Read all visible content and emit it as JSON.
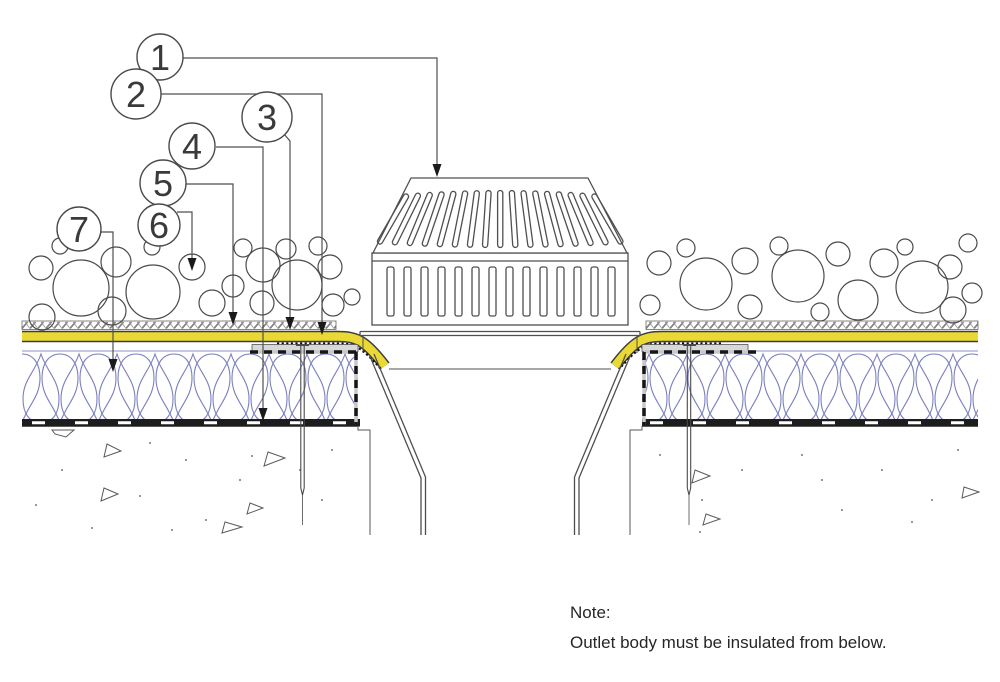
{
  "figure": {
    "type": "roof-outlet-construction-detail",
    "note": {
      "label": "Note:",
      "text": "Outlet body must be insulated from below."
    },
    "callouts": [
      {
        "number": "1"
      },
      {
        "number": "2"
      },
      {
        "number": "3"
      },
      {
        "number": "4"
      },
      {
        "number": "5"
      },
      {
        "number": "6"
      },
      {
        "number": "7"
      }
    ],
    "colors": {
      "membrane_yellow": "#EAD835",
      "insulation_blue": "#7B80BE",
      "line_dark": "#4A4A4A",
      "flange_gray": "#D8D8D8",
      "vapor_barrier_black": "#1D1D1D",
      "hatch_gray": "#7F7F7F",
      "background": "#FFFFFF"
    }
  }
}
